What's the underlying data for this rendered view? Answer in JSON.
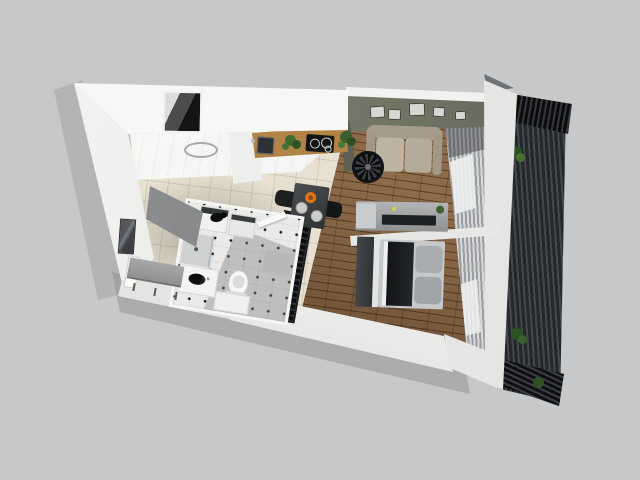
{
  "scene": {
    "type": "3d-floorplan-render",
    "view": "top-down perspective cutaway of a studio apartment",
    "visible_text": "none",
    "palette": {
      "bg": "#c7c8c9",
      "wood": "#8d6b4a",
      "tile": "#e8e1d1",
      "olive": "#707464",
      "tableDark": "#2e3133",
      "orange": "#e0761a",
      "sofaBeige": "#bdb3a3",
      "bedGray": "#c6c9cb",
      "graphite": "#25282b",
      "plantGreen": "#3b6030",
      "wallWhite": "#f3f3f1"
    },
    "rooms": [
      {
        "name": "hallway",
        "floor": "beige ceramic tile",
        "items": [
          "entry-bench",
          "wall-mirror",
          "wardrobe-panel",
          "round-ceiling-lamp",
          "entry-door",
          "ventilation-shaft"
        ]
      },
      {
        "name": "kitchen",
        "floor": "beige ceramic tile",
        "items": [
          "tall-cabinet",
          "wood-countertop",
          "sink",
          "faucet",
          "potted-herb",
          "black-cooktop-with-burners"
        ]
      },
      {
        "name": "dining-area",
        "items": [
          "dark-square-table",
          "black-chair-left",
          "black-chair-right",
          "two-plates",
          "orange-fruit-bowl"
        ]
      },
      {
        "name": "bathroom",
        "floor": "white tile with black accent dots",
        "items": [
          "washing-machine",
          "second-appliance",
          "black-cat",
          "shower-tray",
          "vanity-with-round-black-sink",
          "toilet",
          "drawer-unit",
          "side-cabinet",
          "open-door"
        ]
      },
      {
        "name": "living-area",
        "wall": "olive-green accent wall with five picture frames",
        "floor": "oak plank",
        "items": [
          "beige-sofa",
          "black-spoked-round-coffee-table",
          "potted-plant",
          "dark-bookshelf-with-books"
        ]
      },
      {
        "name": "bedroom",
        "floor": "walnut plank",
        "items": [
          "tv-sideboard",
          "flat-tv",
          "double-bed-dark-duvet",
          "gray-pillows",
          "dark-wardrobe-slab",
          "partition-wall"
        ]
      },
      {
        "name": "facade",
        "items": [
          "window-strip-with-venetian-blinds",
          "white-outer-walls"
        ]
      },
      {
        "name": "balcony",
        "items": [
          "slatted-graphite-railing",
          "louvered-roof-overhang",
          "louvered-lower-deck",
          "railing-posts",
          "planter-plants"
        ]
      }
    ]
  }
}
